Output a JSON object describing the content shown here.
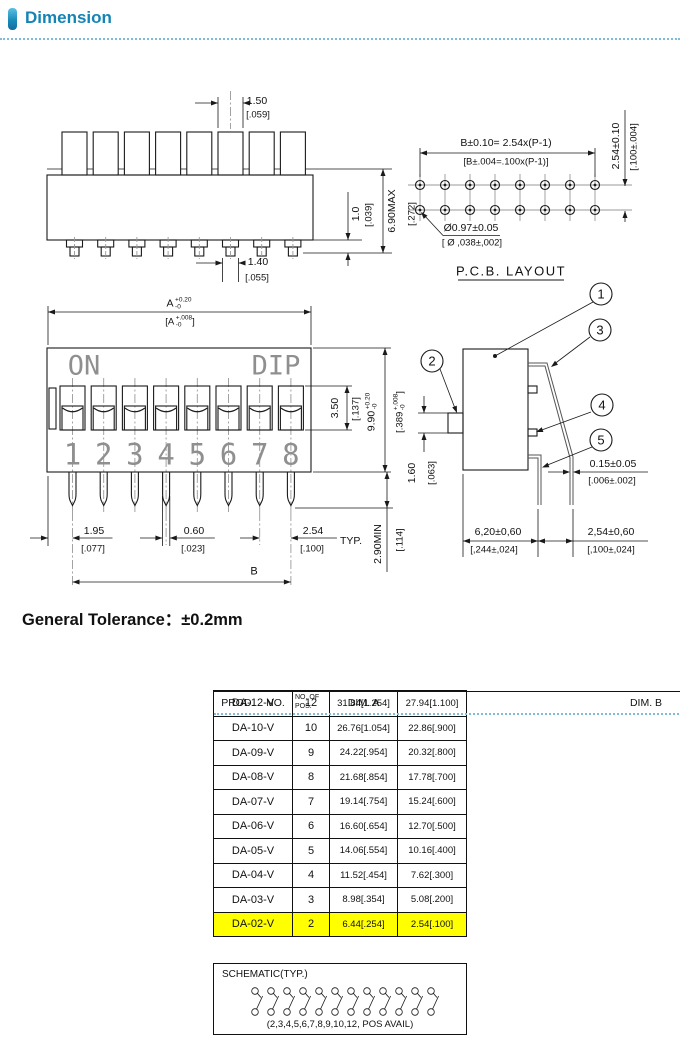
{
  "header": {
    "title": "Dimension"
  },
  "tolerance_note": "General Tolerance：±0.2mm",
  "top_view": {
    "dims": {
      "actuator_w_mm": "1.50",
      "actuator_w_in": "[.059]",
      "pin_mm": "1.40",
      "pin_in": "[.055]",
      "standoff_mm": "1.0",
      "standoff_in": "[.039]",
      "height_mm": "6.90MAX",
      "height_in": "[.272]"
    }
  },
  "pcb_layout": {
    "title": "P.C.B. LAYOUT",
    "span_mm": "B±0.10= 2.54x(P-1)",
    "span_in": "[B±.004=.100x(P-1)]",
    "row_pitch_mm": "2.54±0.10",
    "row_pitch_in": "[.100±.004]",
    "hole_mm": "Ø0.97±0.05",
    "hole_in": "[ Ø ,038±,002]"
  },
  "front_view": {
    "on_label": "ON",
    "dip_label": "DIP",
    "positions": [
      "1",
      "2",
      "3",
      "4",
      "5",
      "6",
      "7",
      "8"
    ],
    "dims": {
      "a": {
        "main": "A",
        "plus": "+0.20",
        "minus": "-0"
      },
      "a_in": {
        "pre": "[A",
        "plus": "+.008",
        "minus": "-0",
        "post": "]"
      },
      "slot_mm": "3.50",
      "slot_in": "[.137]",
      "h": {
        "main": "9.90",
        "plus": "+0.20",
        "minus": "-0"
      },
      "h_in": {
        "pre": "[.389",
        "plus": "+.008",
        "minus": "-0",
        "post": "]"
      },
      "pin_min_mm": "2.90MIN",
      "pin_min_in": "[.114]",
      "end_mm": "1.95",
      "end_in": "[.077]",
      "pinw_mm": "0.60",
      "pinw_in": "[.023]",
      "pitch_mm": "2.54",
      "pitch_in": "[.100]",
      "typ": "TYP.",
      "b_label": "B"
    }
  },
  "side_view": {
    "callouts": [
      "1",
      "2",
      "3",
      "4",
      "5"
    ],
    "dims": {
      "act_mm": "1.60",
      "act_in": "[.063]",
      "lever_mm": "0.15±0.05",
      "lever_in": "[.006±.002]",
      "depth_mm": "6,20±0,60",
      "depth_in": "[,244±,024]",
      "pin_mm": "2,54±0,60",
      "pin_in": "[,100±,024]"
    }
  },
  "table": {
    "highlight_color": "#ffff00",
    "highlighted_product": "DA-02-V",
    "rows": [
      {
        "prod": "DA-12-V",
        "pos": "12",
        "dim_a": "31.84[1.254]",
        "dim_b": "27.94[1.100]"
      },
      {
        "prod": "DA-10-V",
        "pos": "10",
        "dim_a": "26.76[1.054]",
        "dim_b": "22.86[.900]"
      },
      {
        "prod": "DA-09-V",
        "pos": "9",
        "dim_a": "24.22[.954]",
        "dim_b": "20.32[.800]"
      },
      {
        "prod": "DA-08-V",
        "pos": "8",
        "dim_a": "21.68[.854]",
        "dim_b": "17.78[.700]"
      },
      {
        "prod": "DA-07-V",
        "pos": "7",
        "dim_a": "19.14[.754]",
        "dim_b": "15.24[.600]"
      },
      {
        "prod": "DA-06-V",
        "pos": "6",
        "dim_a": "16.60[.654]",
        "dim_b": "12.70[.500]"
      },
      {
        "prod": "DA-05-V",
        "pos": "5",
        "dim_a": "14.06[.554]",
        "dim_b": "10.16[.400]"
      },
      {
        "prod": "DA-04-V",
        "pos": "4",
        "dim_a": "11.52[.454]",
        "dim_b": "7.62[.300]"
      },
      {
        "prod": "DA-03-V",
        "pos": "3",
        "dim_a": "8.98[.354]",
        "dim_b": "5.08[.200]"
      },
      {
        "prod": "DA-02-V",
        "pos": "2",
        "dim_a": "6.44[.254]",
        "dim_b": "2.54[.100]"
      }
    ],
    "footer": {
      "prod": "PROD.    NO.",
      "pos": "NO. OF\nPOS.",
      "dim_a": "DIM. A",
      "dim_b": "DIM. B"
    }
  },
  "schematic": {
    "title": "SCHEMATIC(TYP.)",
    "note": "(2,3,4,5,6,7,8,9,10,12, POS AVAIL)"
  }
}
